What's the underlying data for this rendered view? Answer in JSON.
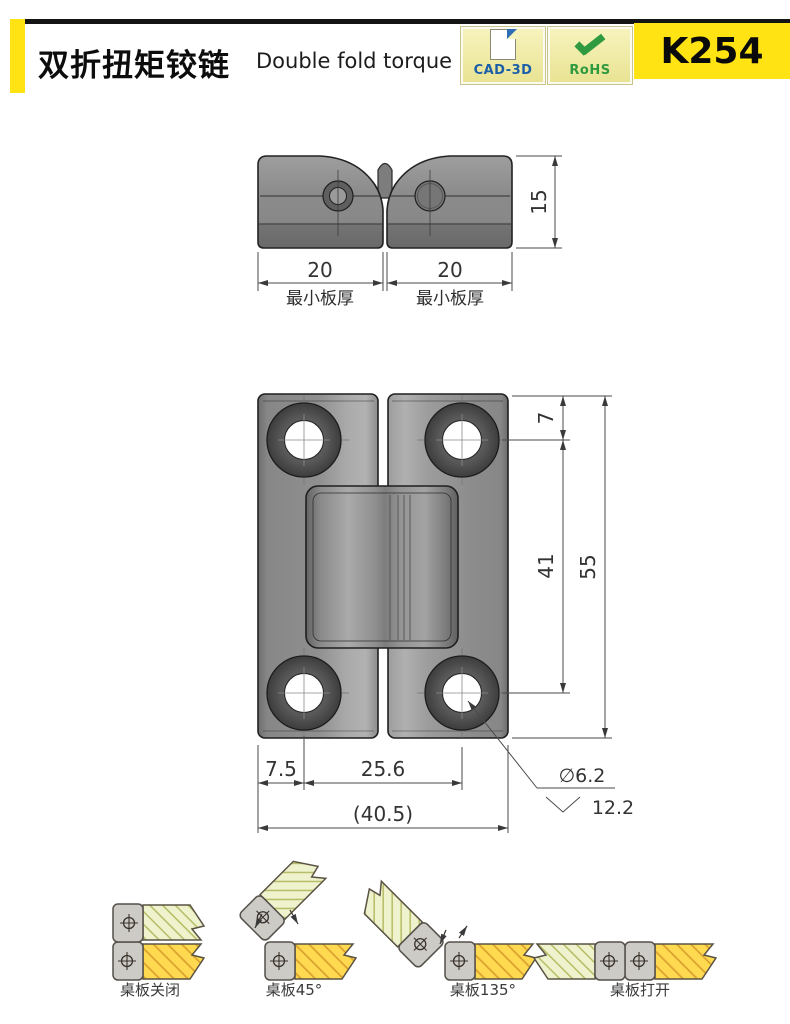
{
  "header": {
    "title_zh": "双折扭矩铰链",
    "title_en": "Double fold torque hinge",
    "badge_cad": "CAD-3D",
    "badge_rohs": "RoHS",
    "part_number": "K254",
    "colors": {
      "accent_yellow": "#FFE312",
      "cad_blue": "#1A5FA8",
      "rohs_green": "#2F9A3F"
    }
  },
  "top_view": {
    "dim_left_width": "20",
    "dim_right_width": "20",
    "dim_thickness": "15",
    "min_plate_label_left": "最小板厚",
    "min_plate_label_right": "最小板厚"
  },
  "front_view": {
    "dim_hole_top_offset": "7",
    "dim_hole_vertical_spacing": "41",
    "dim_overall_height": "55",
    "dim_edge_to_hole": "7.5",
    "dim_hole_horizontal_spacing": "25.6",
    "dim_overall_width": "(40.5)",
    "dim_hole_diameter": "∅6.2",
    "dim_countersink_diameter": "12.2"
  },
  "positions": {
    "closed": "桌板关闭",
    "deg45": "桌板45°",
    "deg135": "桌板135°",
    "open": "桌板打开"
  }
}
